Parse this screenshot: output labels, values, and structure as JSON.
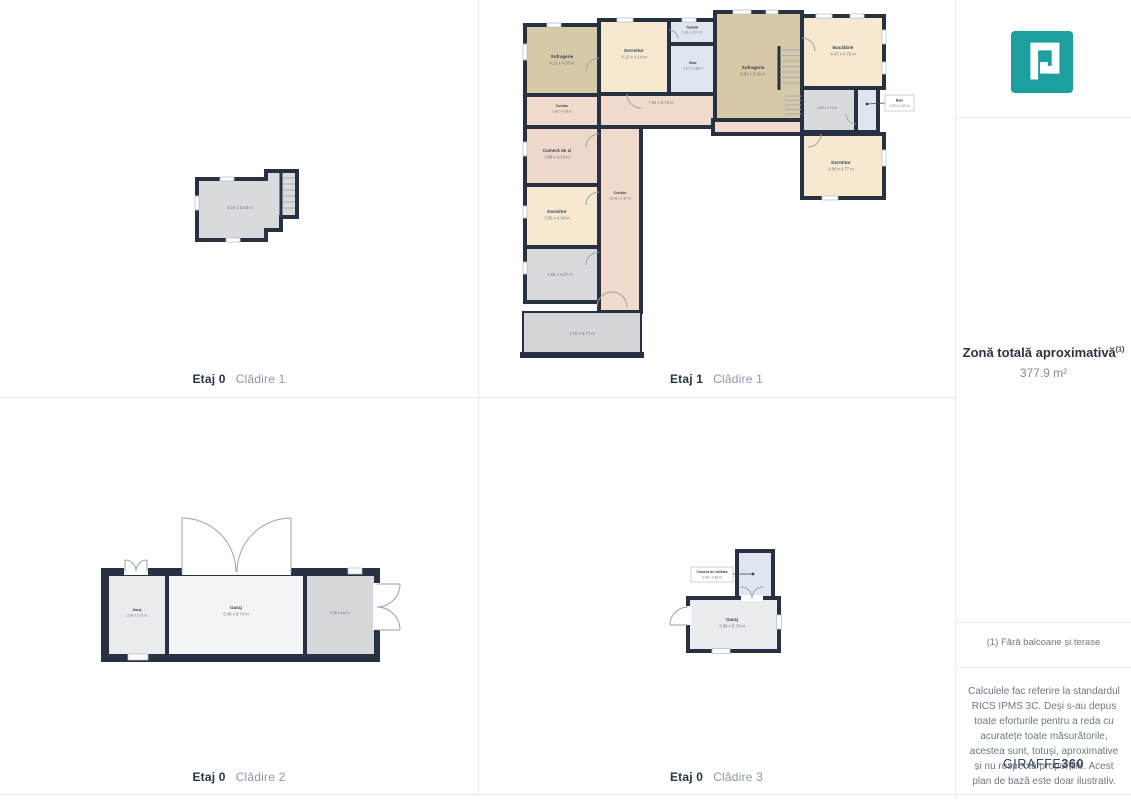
{
  "sidebar": {
    "logo_icon": "giraffe360-logo",
    "total_area_label": "Zonă totală aproximativă",
    "total_area_sup": "(1)",
    "total_area_value": "377.9 m²",
    "footnote": "(1) Fără balcoane și terase",
    "disclaimer": "Calculele fac referire la standardul RICS IPMS 3C. Deși s-au depus toate eforturile pentru a reda cu acuratețe toate măsurătorile, acestea sunt, totuși, aproximative și nu respectă proporțiile. Acest plan de bază este doar ilustrativ.",
    "brand_regular": "GIRAFFE",
    "brand_bold": "360"
  },
  "palette": {
    "wall": "#273142",
    "accent_teal": "#1d9fa0",
    "room_tan": "#d5c9a7",
    "room_cream": "#f7e9d0",
    "room_pink": "#f1dacc",
    "room_pink2": "#eed8cb",
    "room_blue": "#dfe6f0",
    "room_gray": "#d8dadd",
    "room_gray_light": "#e9ebee",
    "room_gray_lighter": "#f3f4f5",
    "room_gray_dark": "#d5d7da",
    "terrace_gray": "#d4d6d9"
  },
  "plans": {
    "p1": {
      "caption_floor": "Etaj 0",
      "caption_building": "Clădire 1",
      "rooms": [
        {
          "name": "",
          "dims": "8.16 x 5.50 m"
        }
      ]
    },
    "p2": {
      "caption_floor": "Etaj 1",
      "caption_building": "Clădire 1",
      "rooms": [
        {
          "name": "Sufragerie",
          "dims": "4.11 x 4.58 m"
        },
        {
          "name": "Dormitor",
          "dims": "4.12 x 4.14 m"
        },
        {
          "name": "Toaletă",
          "dims": "1.31 x 2.97 m"
        },
        {
          "name": "Baie",
          "dims": "2.47 x 2.88 m"
        },
        {
          "name": "Coridor",
          "dims": "1.66 x 4.28 m"
        },
        {
          "name": "",
          "dims": "7.94 x 3.73 m"
        },
        {
          "name": "Cameră de zi",
          "dims": "3.88 x 4.24 m"
        },
        {
          "name": "Coridor",
          "dims": "13.09 x 1.87 m"
        },
        {
          "name": "Dormitor",
          "dims": "3.85 x 4.34 m"
        },
        {
          "name": "",
          "dims": "3.56 x 4.27 m"
        },
        {
          "name": "",
          "dims": "2.70 x 6.77 m"
        },
        {
          "name": "Sufragerie",
          "dims": "6.62 x 5.89 m"
        },
        {
          "name": "Bucătărie",
          "dims": "4.47 x 4.79 m"
        },
        {
          "name": "",
          "dims": "2.89 x 2.21 m"
        },
        {
          "name": "Baie",
          "dims": "2.97 x 1.39 m"
        },
        {
          "name": "Dormitor",
          "dims": "4.00 x 4.77 m"
        }
      ]
    },
    "p3": {
      "caption_floor": "Etaj 0",
      "caption_building": "Clădire 2",
      "rooms": [
        {
          "name": "Garaj",
          "dims": "3.60 x 3.73 m"
        },
        {
          "name": "Garaj",
          "dims": "5.48 x 8.74 m"
        },
        {
          "name": "",
          "dims": "5.38 x 4.42 m"
        }
      ]
    },
    "p4": {
      "caption_floor": "Etaj 0",
      "caption_building": "Clădire 3",
      "rooms": [
        {
          "name": "Cameră de utilitate",
          "dims": "2.08 x 2.82 m"
        },
        {
          "name": "Garaj",
          "dims": "3.88 x 5.79 m"
        }
      ]
    }
  }
}
